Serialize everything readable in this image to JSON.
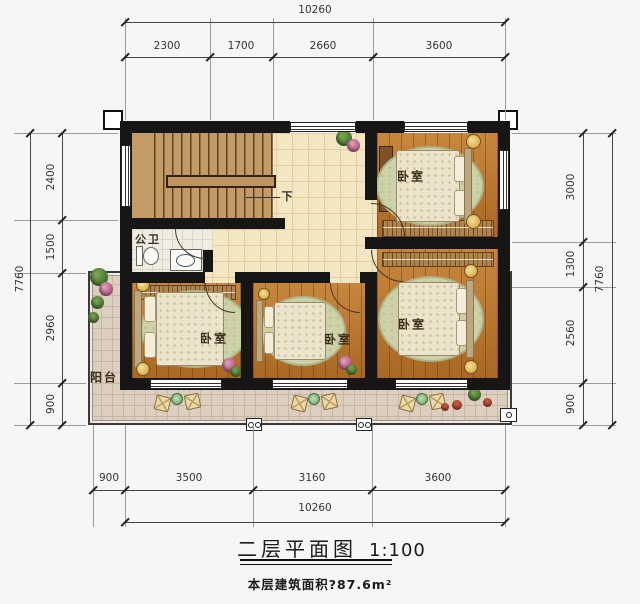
{
  "drawing": {
    "title": "二层平面图",
    "scale": "1:100",
    "area_note": "本层建筑面积?87.6m²"
  },
  "labels": {
    "bedroom": "卧室",
    "bathroom": "公卫",
    "balcony": "阳台",
    "stairs_down": "下"
  },
  "dimensions": {
    "top": {
      "total": "10260",
      "segments": [
        "2300",
        "1700",
        "2660",
        "3600"
      ]
    },
    "bottom": {
      "total": "10260",
      "segments": [
        "900",
        "3500",
        "3160",
        "3600"
      ]
    },
    "left": {
      "total": "7760",
      "segments": [
        "2400",
        "1500",
        "2960",
        "900"
      ]
    },
    "right": {
      "total": "7760",
      "segments": [
        "3000",
        "1300",
        "2560",
        "900"
      ]
    }
  },
  "colors": {
    "wall": "#161616",
    "wood_floor": "#bd7427",
    "stair_wood": "#c49a66",
    "hall_tile": "#f3e6c3",
    "balcony_tile": "#dccfbf",
    "rug_green": "#ccd1a8",
    "lamp_gold": "#dfb34f"
  }
}
